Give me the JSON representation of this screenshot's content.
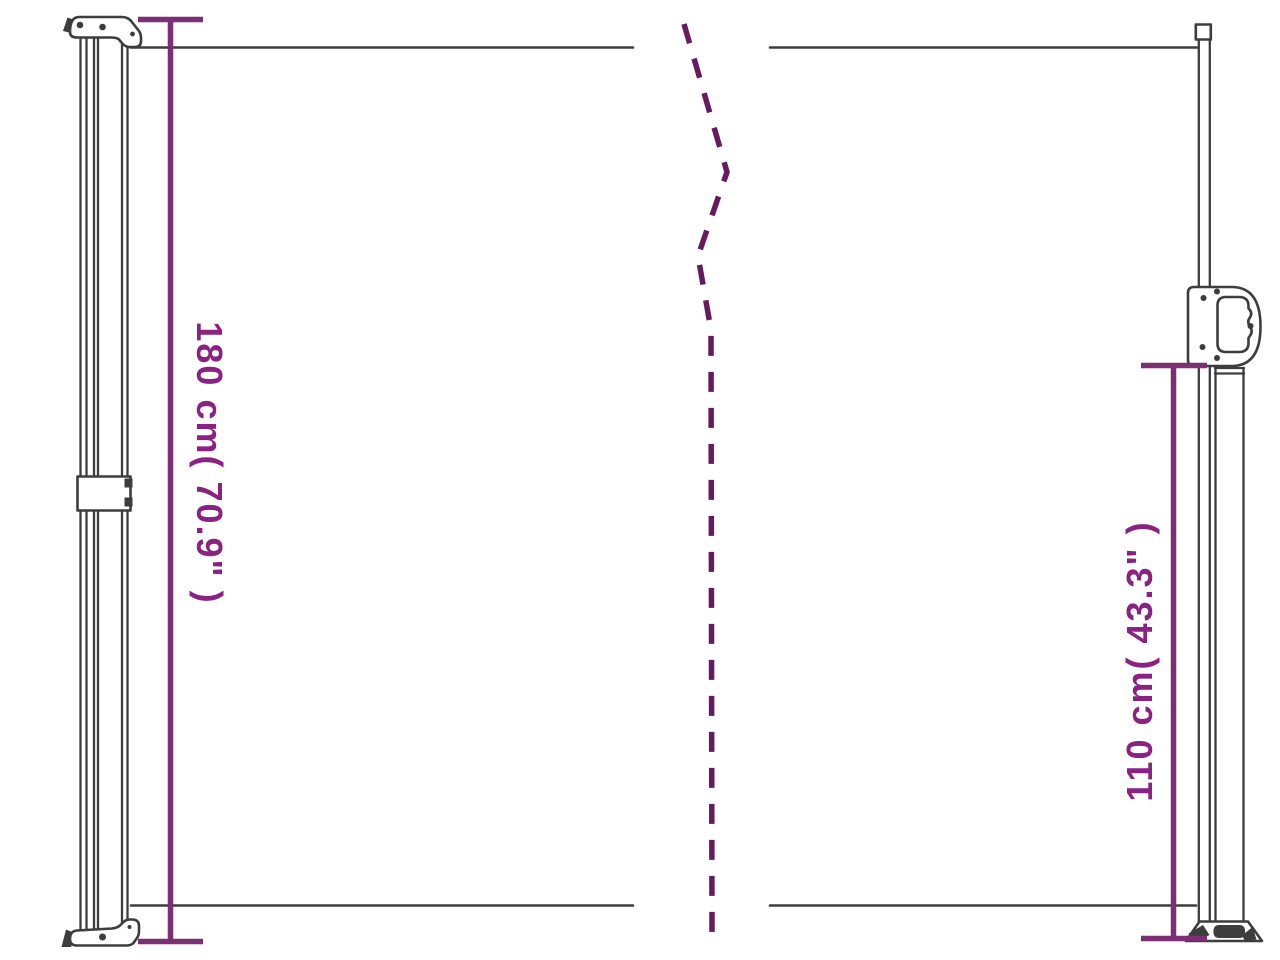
{
  "colors": {
    "line": "#3d3d3d",
    "dimension": "#7d2f76",
    "dash": "#671a60",
    "label": "#8a2183",
    "background": "#ffffff"
  },
  "diagram": {
    "type": "product-dimension-diagram",
    "subject": "retractable-side-awning",
    "left_dimension": {
      "label": "180 cm( 70.9\" )",
      "value_cm": "180",
      "value_inch": "70.9"
    },
    "right_dimension": {
      "label": "110 cm( 43.3\" )",
      "value_cm": "110",
      "value_inch": "43.3"
    }
  }
}
